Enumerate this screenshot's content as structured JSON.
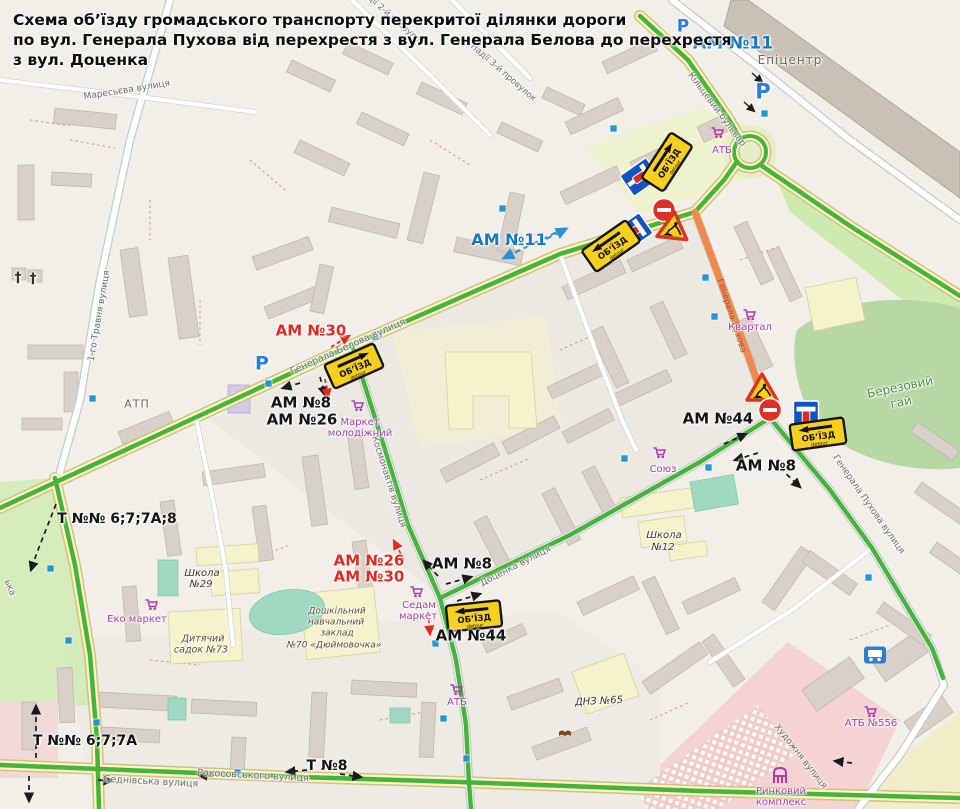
{
  "title": {
    "l1": "Схема об’їзду громадського транспорту перекритої ділянки дороги",
    "l2": "по вул. Генерала Пухова від перехрестя з  вул. Генерала Белова до перехрестя",
    "l3": "з вул. Доценка"
  },
  "signs": {
    "detour_label": "ОБ’ЇЗД",
    "detour_sub": "detour"
  },
  "colors": {
    "bg": "#f2efe9",
    "route_green": "#46b33e",
    "closed_orange": "#ee8a4d",
    "am_blue": "#1879bf",
    "am_red": "#df2b22",
    "poi_magenta": "#ab3dab",
    "parking_blue": "#2a7fdd",
    "sign_yellow": "#f7cf1e",
    "sign_blue": "#1353c4",
    "busstop_blue": "#2596d1",
    "road_yellow": "#fcf6c0",
    "wood_green": "#b7d7a5",
    "grass_green": "#cdebb0",
    "pink_zone": "#f5d3d3",
    "building_grey": "#d9d0c9",
    "building_yellow": "#f6f2cc"
  },
  "labels": [
    {
      "n": "street-maresieva",
      "t": "Маресьєва вулиця",
      "x": 127,
      "y": 91,
      "r": -9,
      "c": "st",
      "s": 9
    },
    {
      "n": "street-travnia",
      "t": "1-го Травня вулиця",
      "x": 100,
      "y": 316,
      "r": -80,
      "c": "st",
      "s": 9
    },
    {
      "n": "street-nadii-2",
      "t": "Надії 2-й провулок",
      "x": 391,
      "y": 17,
      "r": 41,
      "c": "st",
      "s": 8.5
    },
    {
      "n": "street-nadii-3",
      "t": "Надії 3-й провулок",
      "x": 503,
      "y": 73,
      "r": 41,
      "c": "st",
      "s": 8.5
    },
    {
      "n": "street-belova",
      "t": "Генерала Белова вулиця",
      "x": 348,
      "y": 347,
      "r": -24,
      "c": "st",
      "s": 9.5
    },
    {
      "n": "street-kiltsevyi",
      "t": "Кільцевий бульвар",
      "x": 716,
      "y": 110,
      "r": 53,
      "c": "st",
      "s": 9
    },
    {
      "n": "street-kosmonavtiv",
      "t": "Космонавтів вулиця",
      "x": 388,
      "y": 482,
      "r": 72,
      "c": "st",
      "s": 9
    },
    {
      "n": "street-dotsenka",
      "t": "Доценка вулиця",
      "x": 516,
      "y": 567,
      "r": -27,
      "c": "st",
      "s": 9
    },
    {
      "n": "street-pukhova-south",
      "t": "Генерала Пухова вулиця",
      "x": 868,
      "y": 505,
      "r": 55,
      "c": "st",
      "s": 9
    },
    {
      "n": "street-pukhova-closed",
      "t": "Генерала Пухова",
      "x": 731,
      "y": 316,
      "r": 72,
      "c": "stc",
      "s": 8.5
    },
    {
      "n": "street-sednivska",
      "t": "Седнівська вулиця",
      "x": 151,
      "y": 782,
      "r": 3,
      "c": "st",
      "s": 9.5
    },
    {
      "n": "street-rokosovskoho",
      "t": "Рокосовського вулиця",
      "x": 253,
      "y": 776,
      "r": 3,
      "c": "st",
      "s": 9.5
    },
    {
      "n": "street-khudozhnia",
      "t": "Художня вулиця",
      "x": 800,
      "y": 757,
      "r": 52,
      "c": "st",
      "s": 9
    },
    {
      "n": "street-partial",
      "t": "ька",
      "x": 9,
      "y": 588,
      "r": 68,
      "c": "st",
      "s": 9
    },
    {
      "n": "wood-label-berezovyi",
      "t": "Березовий",
      "x": 900,
      "y": 387,
      "r": -12,
      "c": "wood",
      "s": 12
    },
    {
      "n": "wood-label-hai",
      "t": "гай",
      "x": 901,
      "y": 402,
      "r": -12,
      "c": "wood",
      "s": 12
    },
    {
      "n": "route-am11-top",
      "t": "АМ №11",
      "x": 733,
      "y": 44,
      "r": 0,
      "c": "amb",
      "s": 17
    },
    {
      "n": "route-am11-mid",
      "t": "АМ №11",
      "x": 509,
      "y": 240,
      "r": 0,
      "c": "amb",
      "s": 16
    },
    {
      "n": "route-am30-west",
      "t": "АМ №30",
      "x": 311,
      "y": 331,
      "r": 0,
      "c": "amr",
      "s": 15
    },
    {
      "n": "route-am8-west",
      "t": "АМ №8",
      "x": 301,
      "y": 403,
      "r": 0,
      "c": "amk",
      "s": 15
    },
    {
      "n": "route-am26-west",
      "t": "АМ №26",
      "x": 302,
      "y": 420,
      "r": 0,
      "c": "amk",
      "s": 15
    },
    {
      "n": "route-am44-east",
      "t": "АМ №44",
      "x": 718,
      "y": 419,
      "r": 0,
      "c": "amk",
      "s": 15
    },
    {
      "n": "route-am8-east",
      "t": "АМ №8",
      "x": 766,
      "y": 466,
      "r": 0,
      "c": "amk",
      "s": 15
    },
    {
      "n": "route-am26-mid",
      "t": "АМ №26",
      "x": 369,
      "y": 561,
      "r": 0,
      "c": "amr",
      "s": 15
    },
    {
      "n": "route-am30-mid",
      "t": "АМ №30",
      "x": 369,
      "y": 577,
      "r": 0,
      "c": "amr",
      "s": 15
    },
    {
      "n": "route-am8-mid",
      "t": "АМ №8",
      "x": 462,
      "y": 564,
      "r": 0,
      "c": "amk",
      "s": 15
    },
    {
      "n": "route-am44-mid",
      "t": "АМ №44",
      "x": 471,
      "y": 636,
      "r": 0,
      "c": "amk",
      "s": 15
    },
    {
      "n": "route-t-6778a8",
      "t": "Т №№ 6;7;7А;8",
      "x": 117,
      "y": 519,
      "r": 0,
      "c": "amk",
      "s": 14
    },
    {
      "n": "route-t-677a",
      "t": "Т №№ 6;7;7А",
      "x": 85,
      "y": 741,
      "r": 0,
      "c": "amk",
      "s": 14
    },
    {
      "n": "route-t-8",
      "t": "Т №8",
      "x": 327,
      "y": 766,
      "r": 0,
      "c": "amk",
      "s": 14
    },
    {
      "n": "poi-atb-north",
      "t": "АТБ",
      "x": 722,
      "y": 151,
      "r": 0,
      "c": "poi",
      "s": 10
    },
    {
      "n": "poi-market-molodizhnyi-1",
      "t": "Маркет",
      "x": 360,
      "y": 423,
      "r": 0,
      "c": "poi",
      "s": 10
    },
    {
      "n": "poi-market-molodizhnyi-2",
      "t": "молодіжний",
      "x": 360,
      "y": 434,
      "r": 0,
      "c": "poi",
      "s": 10
    },
    {
      "n": "poi-eko-market",
      "t": "Еко маркет",
      "x": 137,
      "y": 620,
      "r": 0,
      "c": "poi",
      "s": 10
    },
    {
      "n": "poi-kvartal",
      "t": "Квартал",
      "x": 750,
      "y": 328,
      "r": 0,
      "c": "poi",
      "s": 10
    },
    {
      "n": "poi-soiuz",
      "t": "Союз",
      "x": 663,
      "y": 470,
      "r": 0,
      "c": "poi",
      "s": 10
    },
    {
      "n": "poi-sedam-1",
      "t": "Седам",
      "x": 419,
      "y": 606,
      "r": 0,
      "c": "poi",
      "s": 10
    },
    {
      "n": "poi-sedam-2",
      "t": "маркет",
      "x": 418,
      "y": 617,
      "r": 0,
      "c": "poi",
      "s": 10
    },
    {
      "n": "poi-atb-south",
      "t": "АТБ",
      "x": 457,
      "y": 703,
      "r": 0,
      "c": "poi",
      "s": 10
    },
    {
      "n": "poi-atb-556",
      "t": "АТБ №556",
      "x": 871,
      "y": 724,
      "r": 0,
      "c": "poi",
      "s": 10
    },
    {
      "n": "poi-rynkovyi-1",
      "t": "Ринковий",
      "x": 781,
      "y": 792,
      "r": 0,
      "c": "poi",
      "s": 10
    },
    {
      "n": "poi-rynkovyi-2",
      "t": "комплекс",
      "x": 781,
      "y": 803,
      "r": 0,
      "c": "poi",
      "s": 10
    },
    {
      "n": "place-epitsentr",
      "t": "Епіцентр",
      "x": 790,
      "y": 60,
      "r": 0,
      "c": "area",
      "s": 12
    },
    {
      "n": "place-atp",
      "t": "АТП",
      "x": 137,
      "y": 404,
      "r": 0,
      "c": "area",
      "s": 11
    },
    {
      "n": "place-shkola29-1",
      "t": "Школа",
      "x": 202,
      "y": 574,
      "r": 0,
      "c": "sch",
      "s": 10
    },
    {
      "n": "place-shkola29-2",
      "t": "№29",
      "x": 201,
      "y": 585,
      "r": 0,
      "c": "sch",
      "s": 10
    },
    {
      "n": "place-shkola12-1",
      "t": "Школа",
      "x": 664,
      "y": 536,
      "r": 0,
      "c": "sch",
      "s": 10
    },
    {
      "n": "place-shkola12-2",
      "t": "№12",
      "x": 663,
      "y": 548,
      "r": 0,
      "c": "sch",
      "s": 10
    },
    {
      "n": "place-sadok73-1",
      "t": "Дитячий",
      "x": 203,
      "y": 639,
      "r": 0,
      "c": "kid",
      "s": 9.5
    },
    {
      "n": "place-sadok73-2",
      "t": "садок №73",
      "x": 201,
      "y": 650,
      "r": 0,
      "c": "kid",
      "s": 9.5
    },
    {
      "n": "place-dnz70-1",
      "t": "Дошкільний",
      "x": 337,
      "y": 612,
      "r": 0,
      "c": "kid",
      "s": 9
    },
    {
      "n": "place-dnz70-2",
      "t": "навчальний",
      "x": 336,
      "y": 623,
      "r": 0,
      "c": "kid",
      "s": 9
    },
    {
      "n": "place-dnz70-3",
      "t": "заклад",
      "x": 337,
      "y": 634,
      "r": 0,
      "c": "kid",
      "s": 9
    },
    {
      "n": "place-dnz70-4",
      "t": "№70 «Дюймовочка»",
      "x": 334,
      "y": 646,
      "r": 0,
      "c": "kid",
      "s": 9
    },
    {
      "n": "place-dnz65",
      "t": "ДНЗ №65",
      "x": 599,
      "y": 702,
      "r": -3,
      "c": "sch",
      "s": 10
    },
    {
      "n": "parking-icon-1",
      "t": "Р",
      "x": 683,
      "y": 27,
      "r": 0,
      "c": "park",
      "s": 17
    },
    {
      "n": "parking-icon-2",
      "t": "Р",
      "x": 763,
      "y": 92,
      "r": 0,
      "c": "park",
      "s": 21
    },
    {
      "n": "parking-icon-3",
      "t": "Р",
      "x": 262,
      "y": 364,
      "r": 0,
      "c": "park",
      "s": 19
    },
    {
      "n": "church-cross-icon-1",
      "t": "†",
      "x": 18,
      "y": 278,
      "r": 0,
      "c": "ch",
      "s": 14
    },
    {
      "n": "church-cross-icon-2",
      "t": "†",
      "x": 33,
      "y": 279,
      "r": 0,
      "c": "ch",
      "s": 14
    }
  ]
}
